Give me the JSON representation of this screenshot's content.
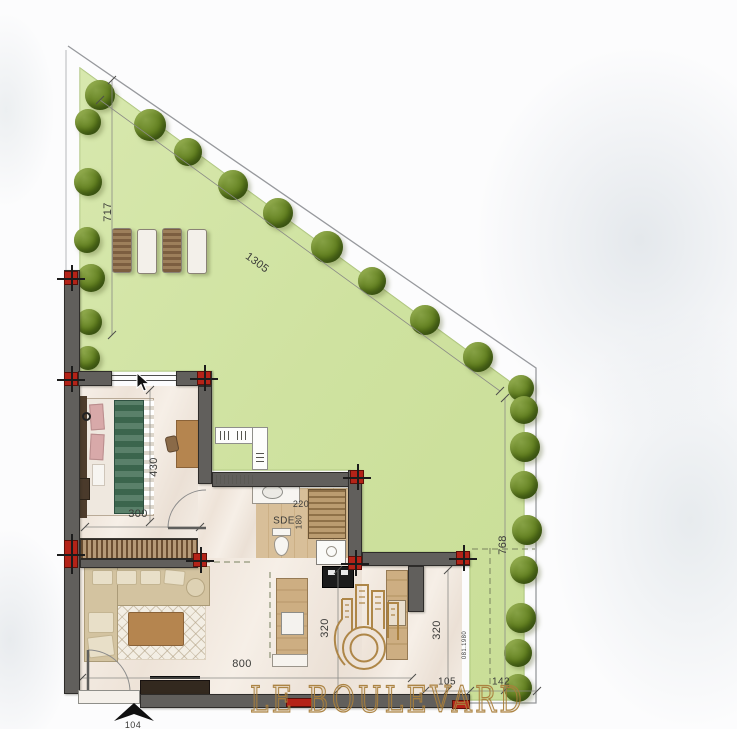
{
  "brand": {
    "name": "LE BOULEVARD"
  },
  "plan": {
    "annotations": [
      {
        "name": "dim-717",
        "text": "717",
        "x": 108,
        "y": 212,
        "rot": -90,
        "fs": 11
      },
      {
        "name": "dim-1305",
        "text": "1305",
        "x": 257,
        "y": 263,
        "rot": 36,
        "fs": 11
      },
      {
        "name": "dim-768",
        "text": "768",
        "x": 503,
        "y": 545,
        "rot": -90,
        "fs": 11
      },
      {
        "name": "dim-430",
        "text": "430",
        "x": 154,
        "y": 467,
        "rot": -90,
        "fs": 11
      },
      {
        "name": "dim-300",
        "text": "300",
        "x": 138,
        "y": 514,
        "rot": 0,
        "fs": 11
      },
      {
        "name": "dim-220",
        "text": "220",
        "x": 301,
        "y": 504,
        "rot": 0,
        "fs": 9
      },
      {
        "name": "room-label-sde",
        "text": "SDE",
        "x": 284,
        "y": 521,
        "rot": 0,
        "fs": 10
      },
      {
        "name": "dim-180",
        "text": "180",
        "x": 299,
        "y": 522,
        "rot": -90,
        "fs": 8
      },
      {
        "name": "dim-800",
        "text": "800",
        "x": 242,
        "y": 664,
        "rot": 0,
        "fs": 11
      },
      {
        "name": "dim-320-kitchen",
        "text": "320",
        "x": 325,
        "y": 628,
        "rot": -90,
        "fs": 11
      },
      {
        "name": "dim-320-patio",
        "text": "320",
        "x": 437,
        "y": 630,
        "rot": -90,
        "fs": 11
      },
      {
        "name": "dim-105",
        "text": "105",
        "x": 447,
        "y": 682,
        "rot": 0,
        "fs": 10
      },
      {
        "name": "dim-142",
        "text": "142",
        "x": 501,
        "y": 682,
        "rot": 0,
        "fs": 10
      },
      {
        "name": "dim-104",
        "text": "104",
        "x": 133,
        "y": 725,
        "rot": 0,
        "fs": 9
      },
      {
        "name": "boundary-ref-label",
        "text": "081.1980",
        "x": 465,
        "y": 645,
        "rot": -90,
        "fs": 6
      }
    ],
    "trees": [
      [
        100,
        95,
        30
      ],
      [
        150,
        125,
        32
      ],
      [
        188,
        152,
        28
      ],
      [
        233,
        185,
        30
      ],
      [
        278,
        213,
        30
      ],
      [
        327,
        247,
        32
      ],
      [
        372,
        281,
        28
      ],
      [
        425,
        320,
        30
      ],
      [
        478,
        357,
        30
      ],
      [
        521,
        388,
        26
      ],
      [
        88,
        122,
        26
      ],
      [
        88,
        182,
        28
      ],
      [
        87,
        240,
        26
      ],
      [
        91,
        278,
        28
      ],
      [
        89,
        322,
        26
      ],
      [
        88,
        358,
        24
      ],
      [
        524,
        410,
        28
      ],
      [
        525,
        447,
        30
      ],
      [
        524,
        485,
        28
      ],
      [
        527,
        530,
        30
      ],
      [
        524,
        570,
        28
      ],
      [
        521,
        618,
        30
      ],
      [
        518,
        653,
        28
      ],
      [
        518,
        688,
        28
      ]
    ],
    "loungers": [
      {
        "x": 112,
        "y": 228,
        "t": "wood"
      },
      {
        "x": 137,
        "y": 229,
        "t": "white"
      },
      {
        "x": 162,
        "y": 228,
        "t": "wood"
      },
      {
        "x": 187,
        "y": 229,
        "t": "white"
      }
    ]
  },
  "colors": {
    "lawn": "#cfe2a0",
    "lawn_edge": "#a9c178",
    "wall": "#615f5c",
    "column_red": "#b42318",
    "gold": "#a97f3c",
    "floor": "#f2eae2",
    "wood": "#c9a87c"
  }
}
